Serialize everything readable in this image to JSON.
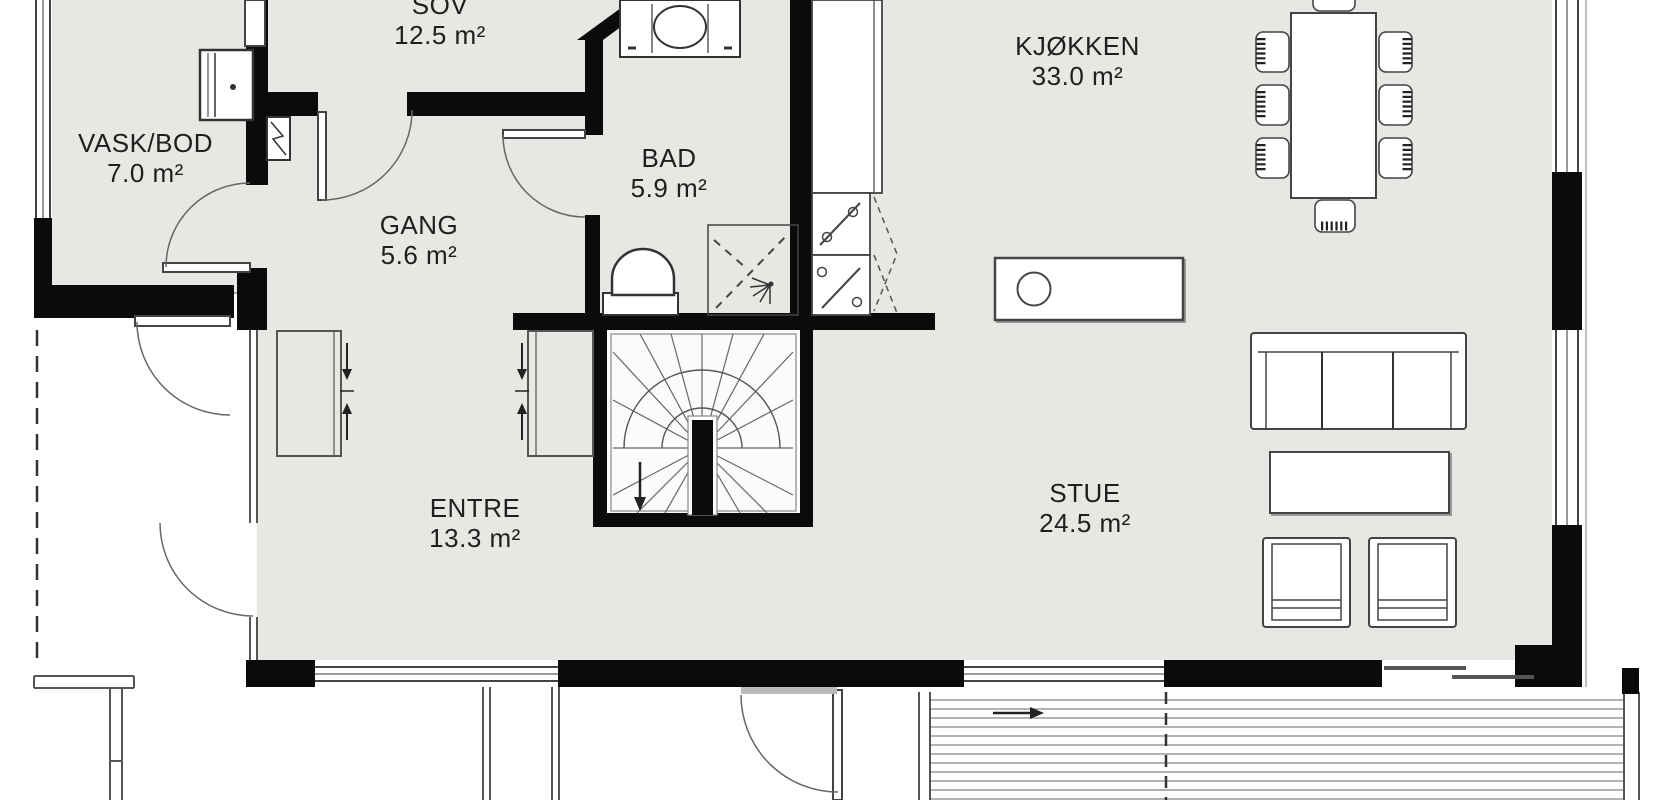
{
  "plan": {
    "type": "floor-plan",
    "language": "Norwegian",
    "rooms": [
      {
        "id": "sov",
        "name": "SOV",
        "area": "12.5 m²"
      },
      {
        "id": "vaskbod",
        "name": "VASK/BOD",
        "area": "7.0 m²"
      },
      {
        "id": "bad",
        "name": "BAD",
        "area": "5.9 m²"
      },
      {
        "id": "gang",
        "name": "GANG",
        "area": "5.6 m²"
      },
      {
        "id": "kjokken",
        "name": "KJØKKEN",
        "area": "33.0 m²"
      },
      {
        "id": "entre",
        "name": "ENTRE",
        "area": "13.3 m²"
      },
      {
        "id": "stue",
        "name": "STUE",
        "area": "24.5 m²"
      }
    ],
    "fixtures": [
      "washing-machine-icon",
      "electrical-cabinet-icon",
      "vanity-sink-icon",
      "toilet-icon",
      "shower-icon",
      "kitchen-tall-cabinet-icon",
      "oven-icon",
      "dishwasher-icon",
      "kitchen-island-sink-icon",
      "dining-table-icon",
      "dining-chair-icon",
      "sofa-icon",
      "coffee-table-icon",
      "armchair-icon",
      "wardrobe-icon",
      "winder-staircase-icon",
      "terrace-deck-icon",
      "direction-arrow-icon"
    ],
    "colors": {
      "wall": "#0b0b0b",
      "floor": "#e8e7e4",
      "stair_floor": "#fbfbfa",
      "thin_line": "#555555",
      "plank_line": "#9a9a9a",
      "background": "#ffffff",
      "text": "#1f1f1f"
    }
  }
}
